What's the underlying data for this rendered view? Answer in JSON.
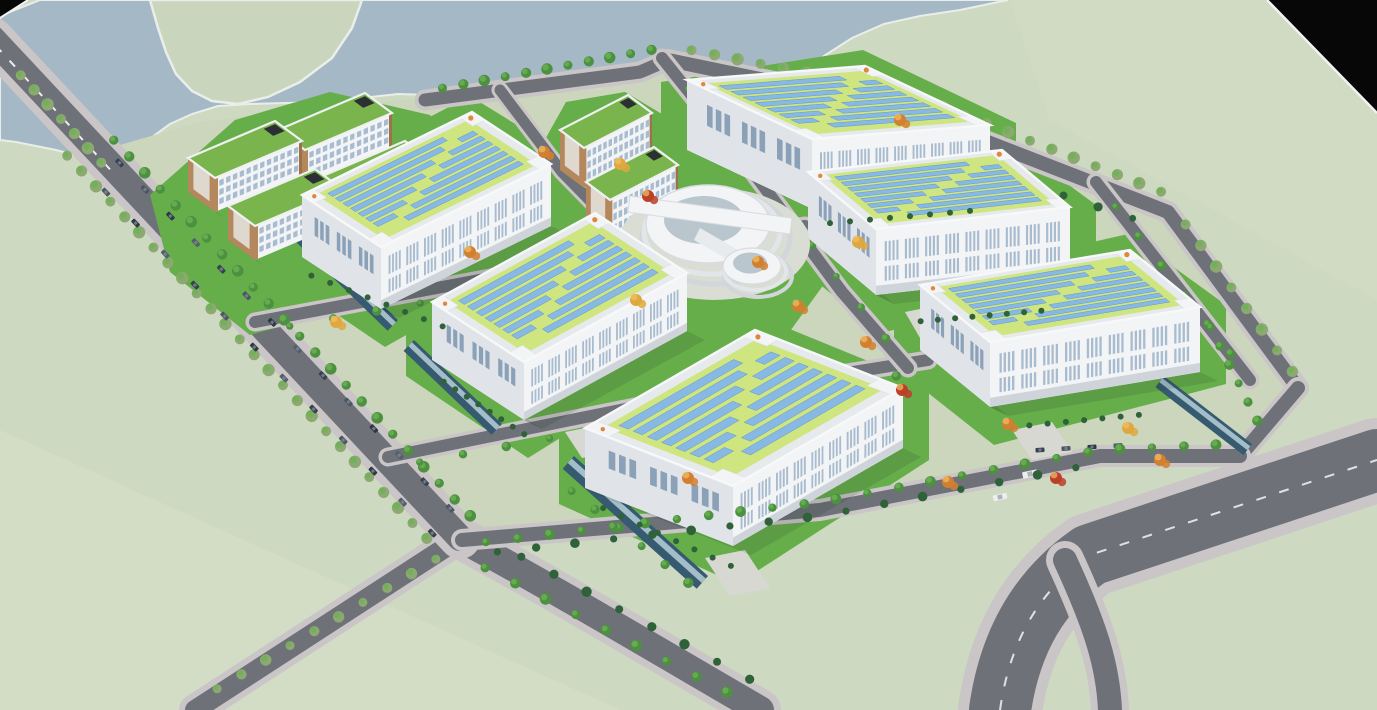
{
  "meta": {
    "title": "Industrial park campus aerial 3D rendering",
    "type": "architectural-visualization",
    "view": "birds-eye-perspective",
    "image_width": 1377,
    "image_height": 710
  },
  "scene": {
    "environment": {
      "water": "lake band along the top edge with a pale green island",
      "terrain": "pale sage-green open fields around the campus",
      "frame": "black clipped triangles in the top-left and top-right corners"
    },
    "campus": {
      "solar_warehouse_count": 6,
      "office_slab_count": 6,
      "circular_landmark_count": 1,
      "features": [
        "rooftop solar panel arrays on yellow-green roof decks",
        "green roofs with white parapets on office slabs",
        "tree lined perimeter and internal roads",
        "roadside parallel parking with cars",
        "reflecting canals along warehouse edges",
        "autumn orange and evergreen landscaping"
      ]
    },
    "roads": {
      "perimeter_loop": true,
      "internal_grid": true,
      "public_road_dashes": "white dashed center lines",
      "exits": [
        "bottom-left",
        "bottom-center",
        "bottom-right wide highway"
      ]
    }
  },
  "palette": {
    "field": "#ced9c2",
    "fieldLight": "#d7e0cb",
    "water": "#a4b8c6",
    "island": "#c9d5bc",
    "shore": "#eaeeea",
    "black": "#070707",
    "edgeWhite": "#f2f2f2",
    "road": "#6e7177",
    "roadDark": "#66696f",
    "sidewalk": "#cac5c6",
    "dash": "#ededed",
    "campus": "#cbd6bd",
    "lawn": "#66ae4a",
    "lawnDark": "#51993d",
    "roofGreen": "#cfe57f",
    "roofBase": "#e7eaec",
    "roofShade": "#dde1e6",
    "solar": "#87b9e4",
    "solarEdge": "#6498ca",
    "wallWhite": "#f2f4f6",
    "wallShade": "#e0e4e9",
    "wallDark": "#cfd4db",
    "winBand": "#a9bccf",
    "winDark": "#8ba1b8",
    "trim": "#b5875d",
    "trimDark": "#9e7148",
    "officeRoof": "#79b54c",
    "glass": "#b9c6ce",
    "canal": "#365a70",
    "canalLight": "#a4bec9",
    "treeGreen": "#4d9040",
    "treeLight": "#6cb254",
    "treeSage": "#8ca971",
    "hedge": "#2f6238",
    "autumnOrange": "#d2802f",
    "autumnRed": "#bc4028",
    "autumnYellow": "#dfa83e",
    "carDark": "#39414e",
    "carMid": "#4c5662",
    "truckWhite": "#eceef0",
    "apron": "#d8d8d3",
    "orangeDot": "#e0873c",
    "shadow": "rgba(20,30,25,0.12)"
  }
}
